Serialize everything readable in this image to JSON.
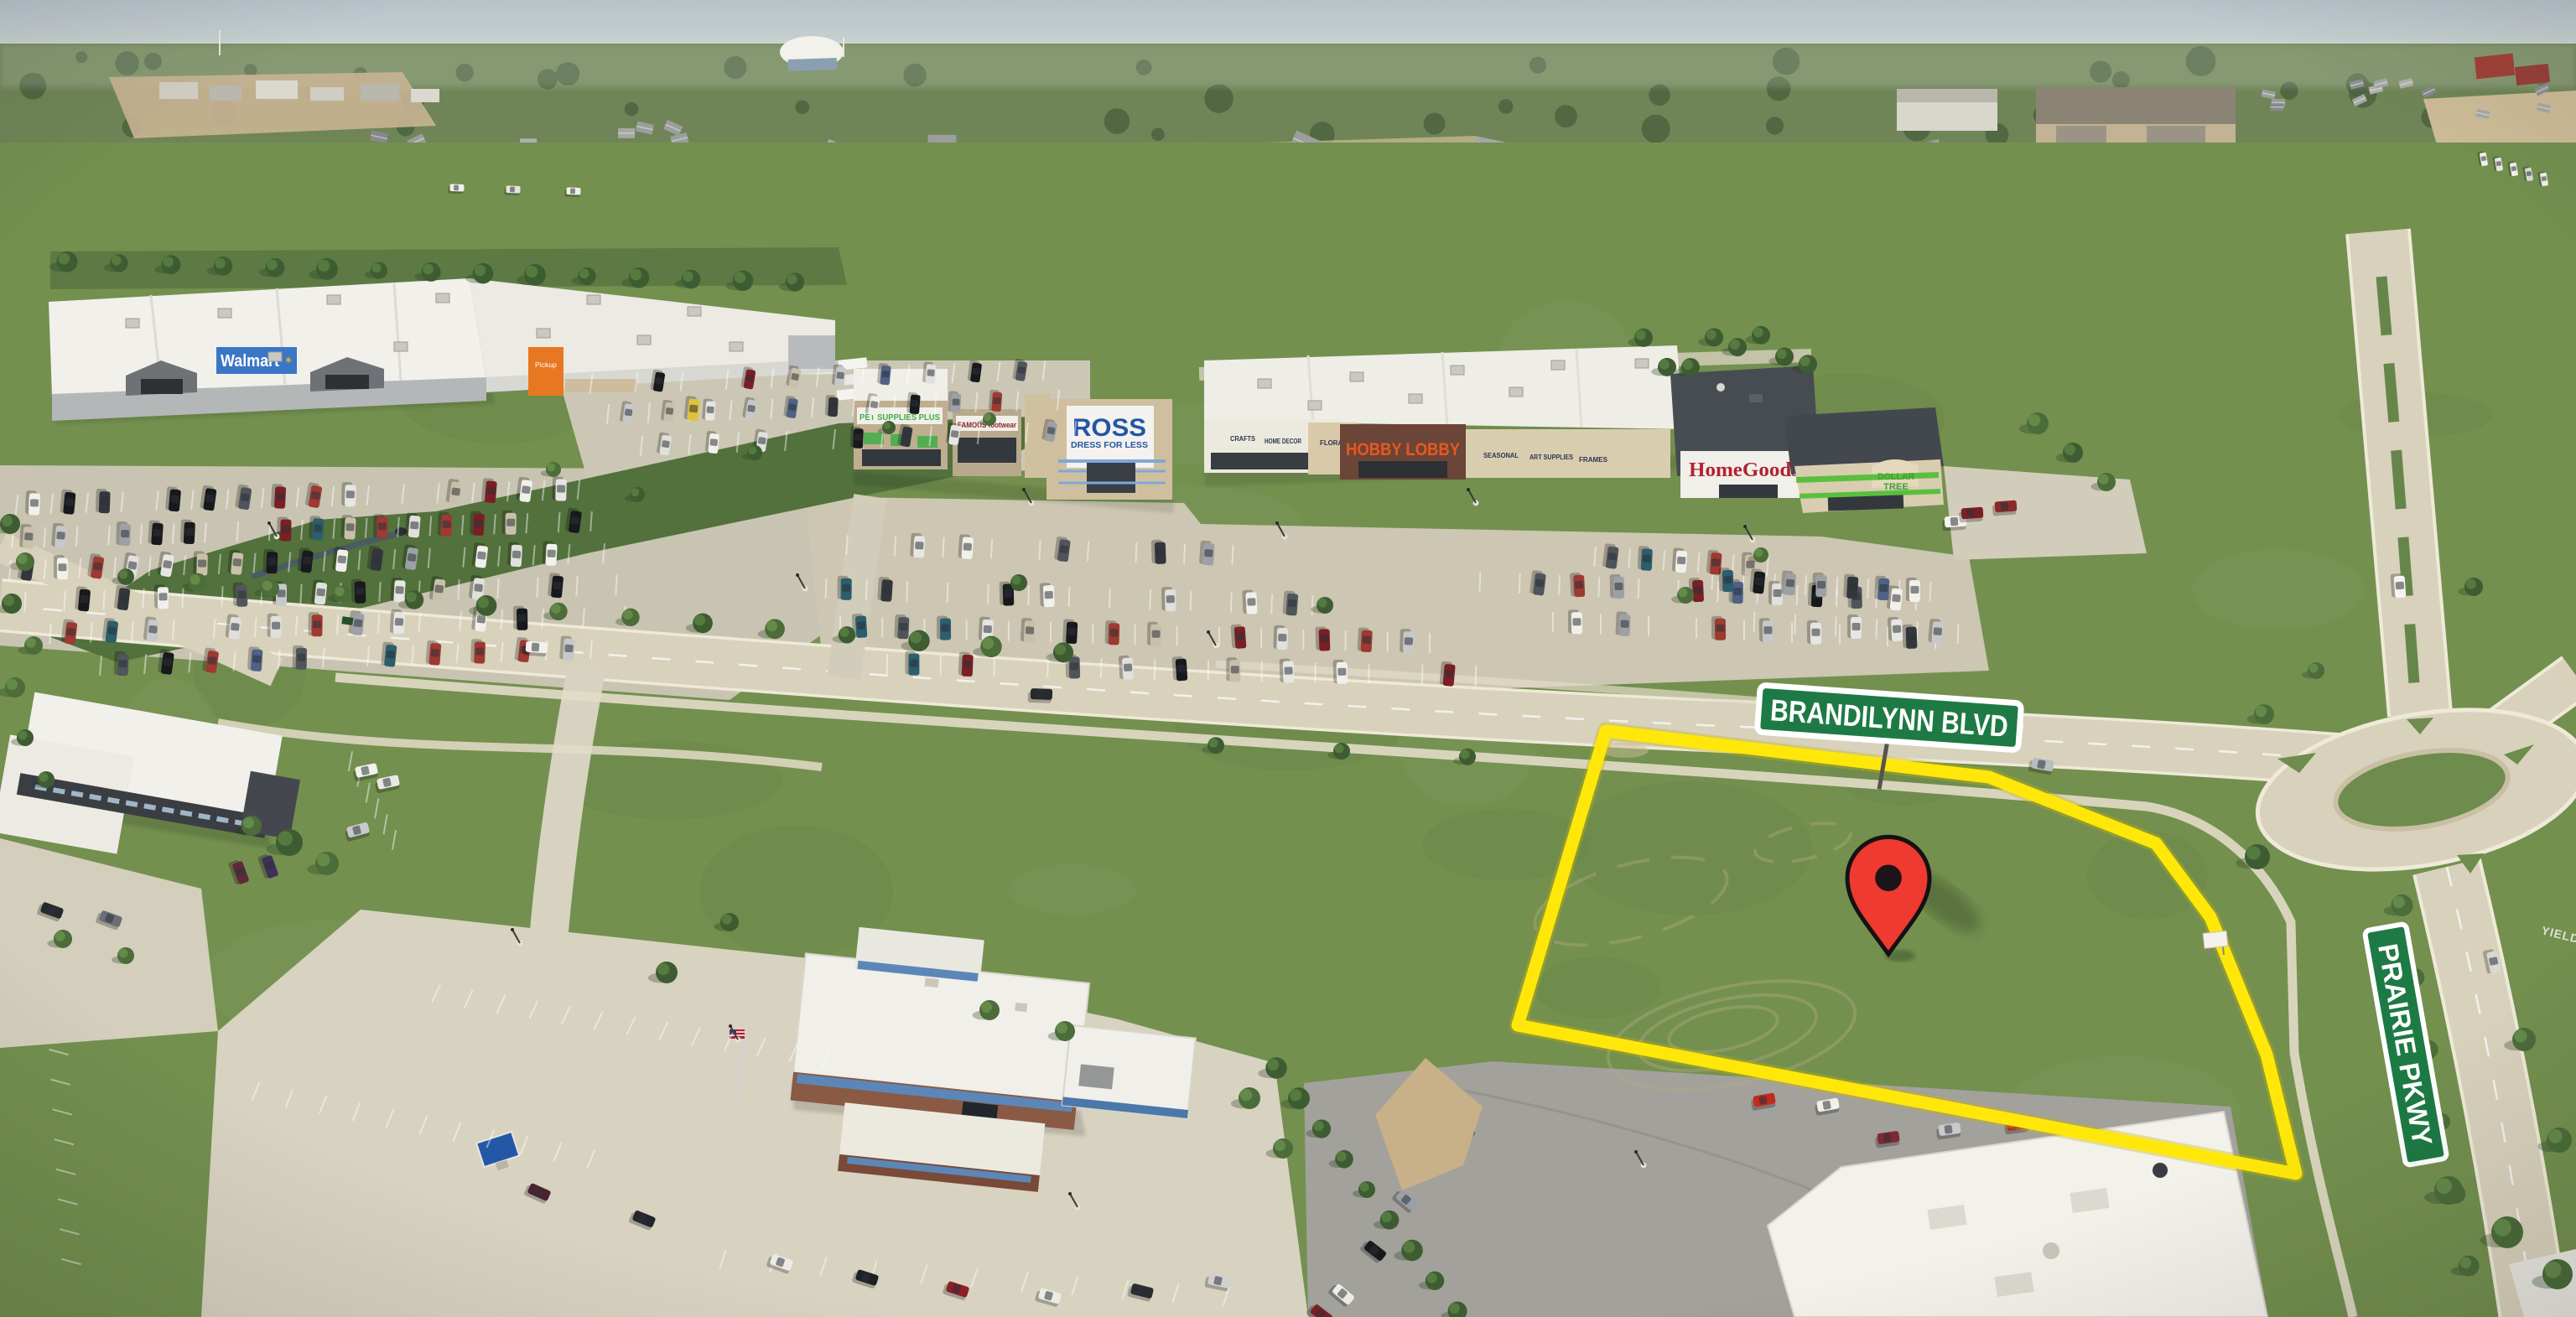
{
  "scene": {
    "description": "Aerial drone photo of a retail corridor with a vacant land parcel outlined in yellow, marked with a red map pin, at the corner of Brandilynn Blvd and Prairie Pkwy"
  },
  "annotations": {
    "street_signs": [
      {
        "id": "brandilynn",
        "text": "BRANDILYNN BLVD",
        "bg": "#1e7a45",
        "border": "#ffffff",
        "text_color": "#ffffff"
      },
      {
        "id": "prairie",
        "text": "PRAIRIE PKWY",
        "bg": "#1e7a45",
        "border": "#ffffff",
        "text_color": "#ffffff"
      }
    ],
    "road_markings": [
      "YIELD"
    ],
    "parcel_outline": {
      "color": "#ffe70a"
    },
    "map_pin": {
      "fill": "#ee3a30",
      "outline": "#161213",
      "hole": "#1c1418"
    }
  },
  "stores": {
    "walmart": {
      "label": "Walmart",
      "spark_glyph": "✶",
      "pickup_label": "Pickup",
      "band_color": "#3a76c6",
      "accent_color": "#e87722",
      "text_color": "#ffffff"
    },
    "pet_supplies_plus": {
      "label": "PET SUPPLIES PLUS",
      "color": "#3fae49"
    },
    "famous_footwear": {
      "label": "FAMOUS footwear",
      "color": "#8a2433"
    },
    "ross": {
      "label": "ROSS",
      "tagline": "DRESS FOR LESS",
      "color": "#2456a4"
    },
    "hobby_lobby": {
      "label": "HOBBY LOBBY",
      "color": "#e8581d",
      "dept_signs": [
        "CRAFTS",
        "HOME DECOR",
        "FLORAL",
        "SEASONAL",
        "ART SUPPLIES",
        "FRAMES"
      ]
    },
    "homegoods": {
      "label": "HomeGoods",
      "color": "#b22330"
    },
    "dollar_tree": {
      "label_line1": "DOLLAR",
      "label_line2": "TREE",
      "color": "#3f9e35"
    }
  }
}
